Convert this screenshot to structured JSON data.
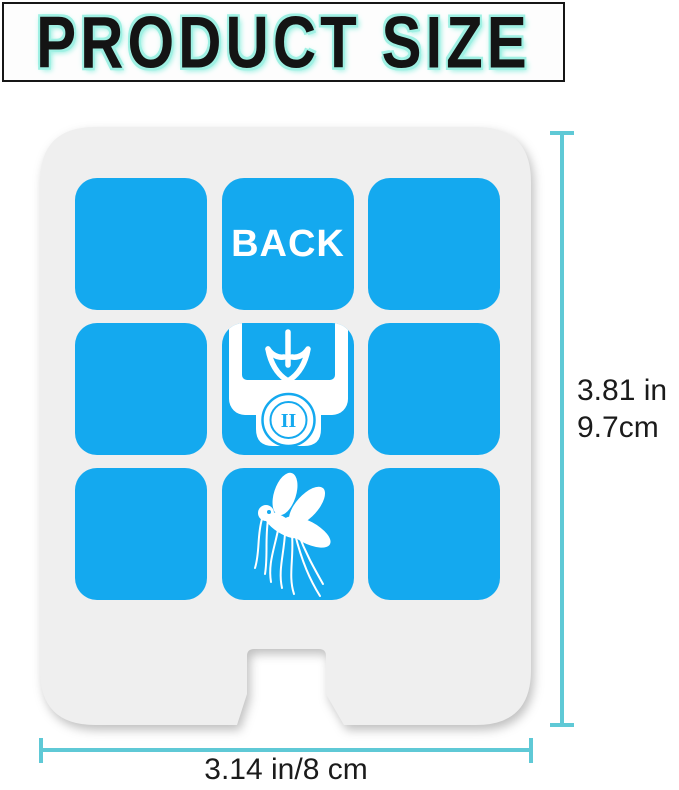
{
  "header": {
    "title": "PRODUCT SIZE"
  },
  "product": {
    "back_label": "BACK",
    "socket_label": "II",
    "icons": {
      "insert": "insert-arrow-plug-icon",
      "mosquito": "mosquito-icon"
    }
  },
  "dimensions": {
    "height_in": "3.81 in",
    "height_cm": "9.7cm",
    "width_label": "3.14 in/8 cm"
  },
  "colors": {
    "tile_blue": "#14A9EF",
    "dimension_cyan": "#5FC9D6",
    "title_glow": "#9FF0E3",
    "card_gray": "#EFEFEF"
  }
}
